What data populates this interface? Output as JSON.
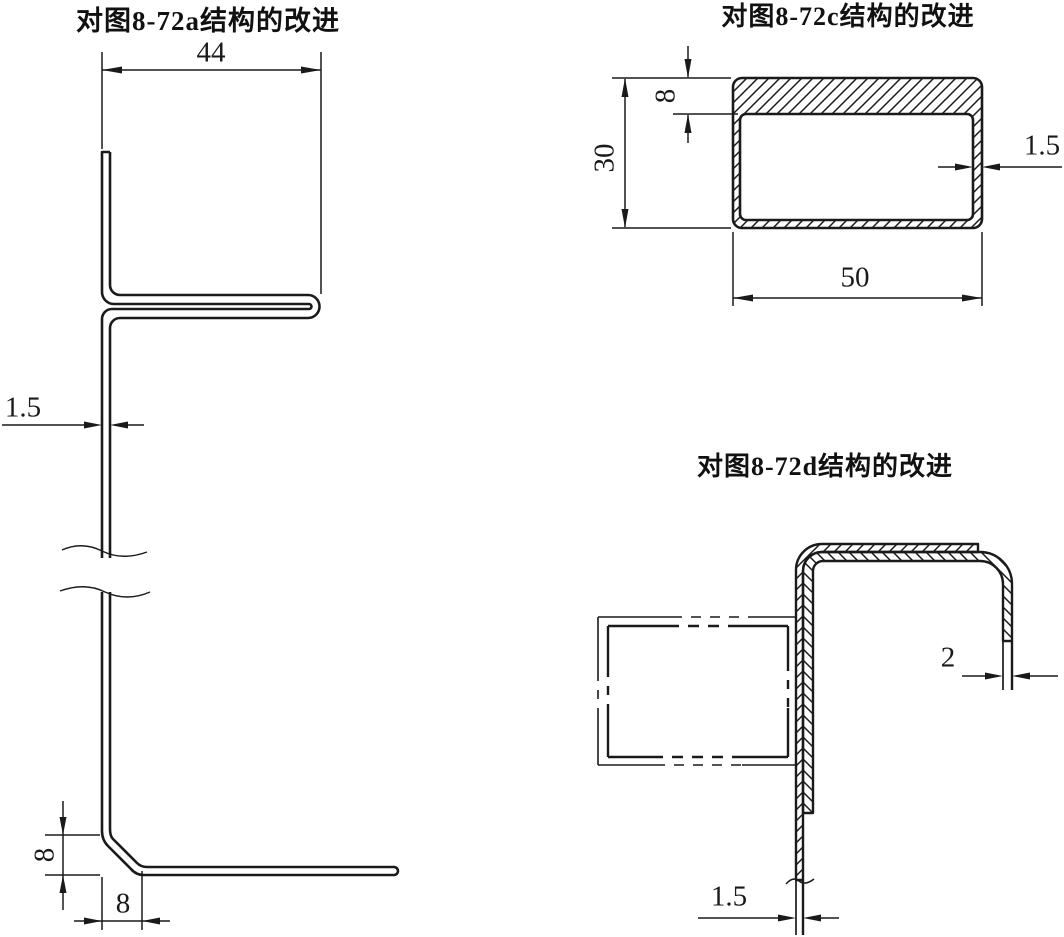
{
  "page": {
    "background": "#ffffff",
    "ink": "#1a1a1a"
  },
  "figure_a": {
    "title": "对图8-72a结构的改进",
    "dim_flange_width": "44",
    "dim_sheet_thickness": "1.5",
    "dim_foot_height": "8",
    "dim_foot_width": "8"
  },
  "figure_c": {
    "title": "对图8-72c结构的改进",
    "dim_top_wall_thickness": "8",
    "dim_section_height": "30",
    "dim_side_wall_thickness": "1.5",
    "dim_section_width": "50"
  },
  "figure_d": {
    "title": "对图8-72d结构的改进",
    "dim_outer_sheet_thickness": "2",
    "dim_inner_sheet_thickness": "1.5"
  }
}
